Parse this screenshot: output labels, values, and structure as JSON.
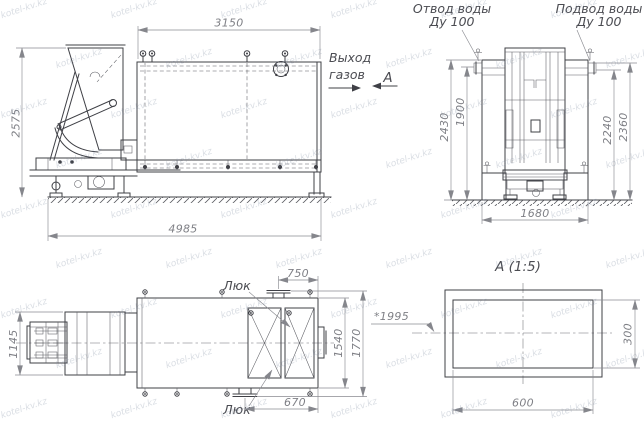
{
  "watermark": {
    "text": "kotel-kv.kz"
  },
  "side_view": {
    "dims": {
      "width_top": "3150",
      "height_left": "2575",
      "length_bottom": "4985"
    },
    "gas_outlet_label_lines": [
      "Выход",
      "газов"
    ],
    "view_arrow_label": "А"
  },
  "end_view": {
    "water_outlet_label_lines": [
      "Отвод воды",
      "Ду 100"
    ],
    "water_inlet_label_lines": [
      "Подвод воды",
      "Ду 100"
    ],
    "dims": {
      "height_outer_left": "2430",
      "height_inner_left": "1900",
      "height_inner_right": "2240",
      "height_outer_right": "2360",
      "width_bottom": "1680"
    }
  },
  "plan_view": {
    "hatch_label_top": "Люк",
    "hatch_label_bottom": "Люк",
    "reference_note": "*1995",
    "dims": {
      "width_left": "1145",
      "top": "750",
      "bottom": "670",
      "height_inner_right": "1540",
      "height_outer_right": "1770"
    }
  },
  "detail_view": {
    "title": "А (1:5)",
    "dims": {
      "width": "600",
      "height": "300"
    }
  },
  "colors": {
    "line": "#3f4046",
    "dimension": "#8a8b91",
    "label": "#4b4c52",
    "watermark": "#7884a0"
  }
}
